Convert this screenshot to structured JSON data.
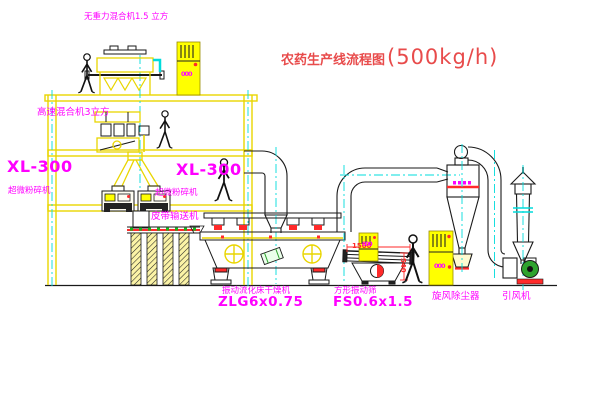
{
  "title": {
    "text": "农药生产线流程图",
    "capacity": "(500kg/h)"
  },
  "labels": {
    "gravity_mixer": "无重力混合机1.5 立方",
    "high_speed_mixer": "高速混合机3立方",
    "mill_left_model": "XL-300",
    "mill_left_name": "超微粉碎机",
    "mill_mid_model": "XL-300",
    "mill_mid_name": "超微粉碎机",
    "belt_conveyor": "皮带输送机",
    "dryer_name": "振动流化床干燥机",
    "dryer_model": "ZLG6x0.75",
    "sieve_name": "方形振动筛",
    "sieve_model": "FS0.6x1.5",
    "cyclone": "旋风除尘器",
    "fan": "引风机"
  },
  "dimensions": {
    "sieve_length": "1500",
    "sieve_height": "540"
  },
  "cabinets": {
    "roof_mark": "000",
    "mid_mark": "000",
    "right_mark": "000"
  },
  "colors": {
    "structure_yellow": "#e9d500",
    "cabinet_yellow": "#ffff00",
    "centerline_cyan": "#00dcdc",
    "label_magenta": "#ff00ff",
    "title_red": "#e84b4b",
    "dimension_red": "#ff2a2a",
    "belt_green": "#18b518",
    "fan_green": "#2ea32e",
    "line_black": "#1a1a1a"
  }
}
